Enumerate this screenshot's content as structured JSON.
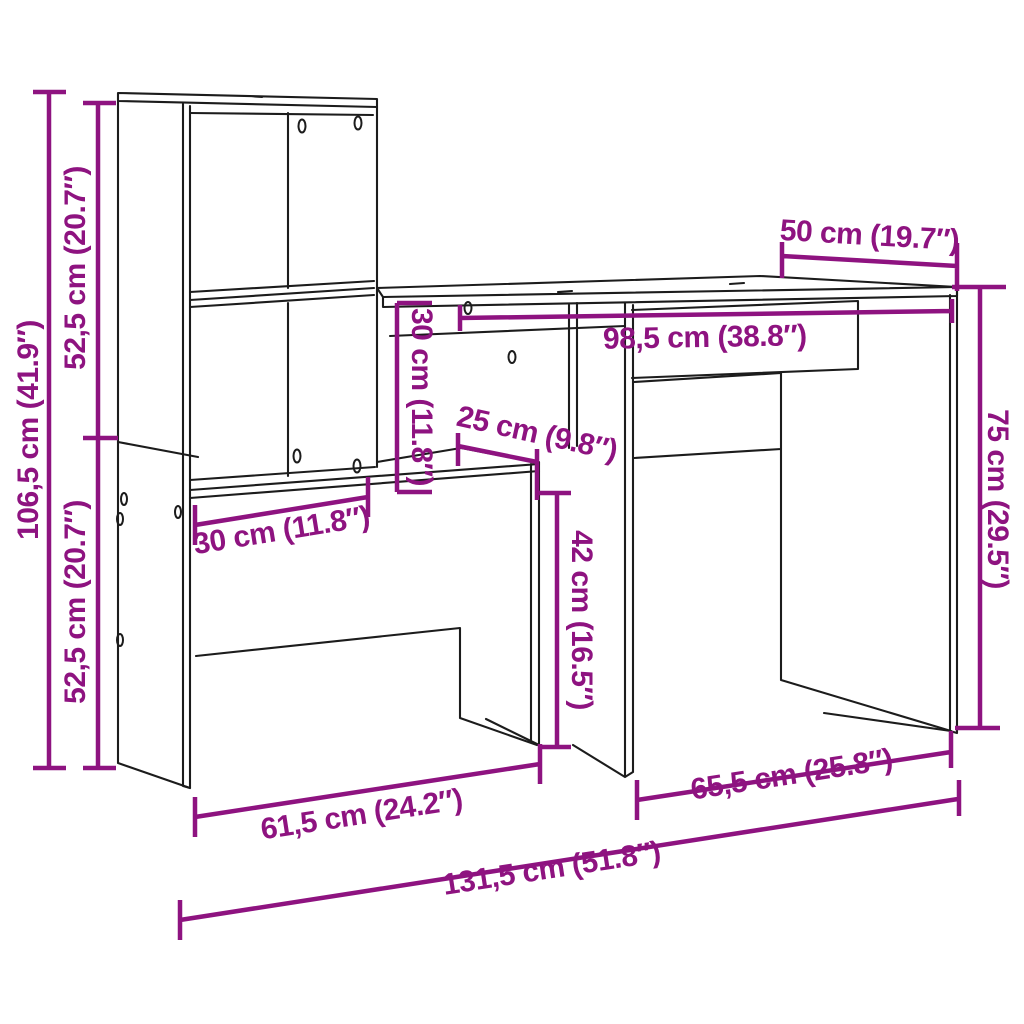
{
  "diagram": {
    "colors": {
      "dimension": "#8E1380",
      "outline": "#1C1C1C",
      "background": "#FFFFFF"
    },
    "dimensions": {
      "overall_height": "106,5 cm (41.9″)",
      "upper_section_height": "52,5 cm (20.7″)",
      "lower_section_height": "52,5 cm (20.7″)",
      "desk_depth": "50 cm (19.7″)",
      "desktop_width": "98,5 cm (38.8″)",
      "shelf_drop": "30 cm (11.8″)",
      "shelf_depth": "25 cm (9.8″)",
      "tower_width": "30 cm (11.8″)",
      "under_shelf_height": "42 cm (16.5″)",
      "desk_height": "75 cm (29.5″)",
      "left_section_width": "61,5 cm (24.2″)",
      "right_section_width": "65,5 cm (25.8″)",
      "overall_width": "131,5 cm (51.8″)"
    }
  }
}
